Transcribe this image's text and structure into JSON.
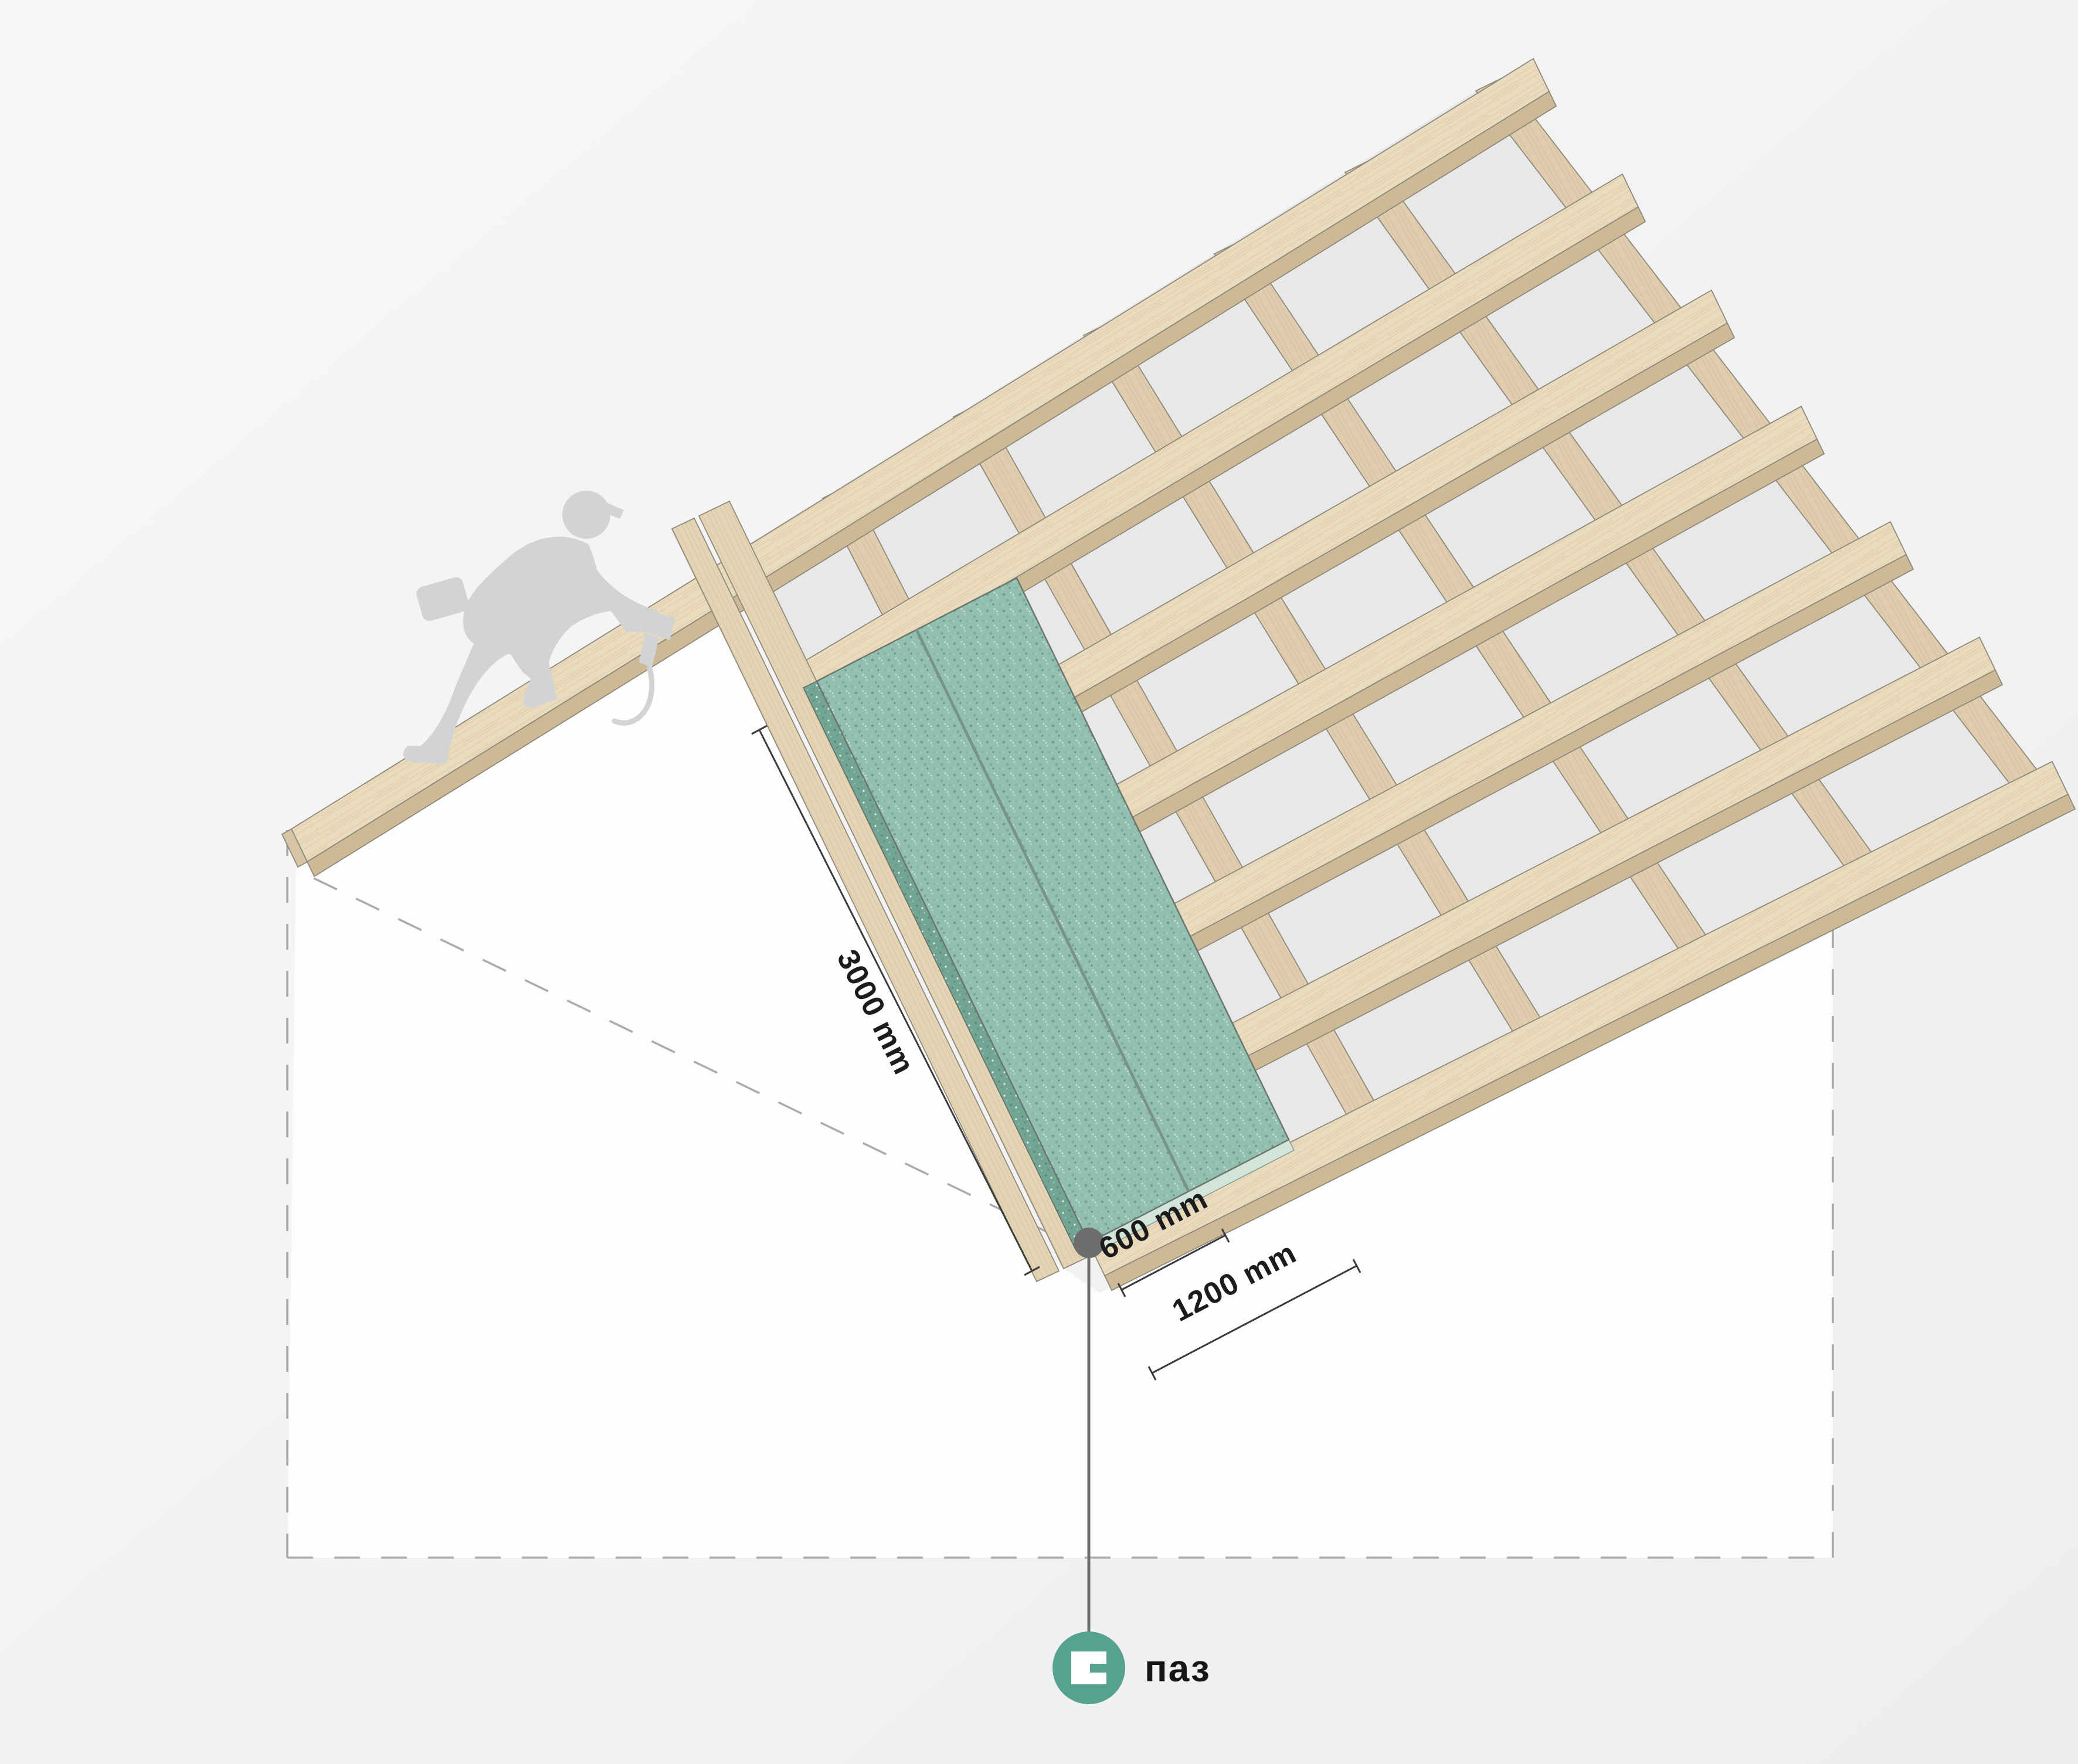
{
  "diagram": {
    "kind": "roof-sheathing-panel-installation-isometric",
    "dimensions": {
      "panel_length": "3000 mm",
      "panel_width": "600 mm",
      "coverage_width": "1200 mm"
    },
    "legend": {
      "icon": "groove-icon",
      "label": "паз"
    },
    "colors": {
      "background": "#f3f3f4",
      "wall": "#fdfdfe",
      "membrane": "#e8e8e9",
      "wood_face": "#e9dbbd",
      "wood_bevel": "#cdb995",
      "rafter_face": "#dcc9a9",
      "panel_green": "#92bfae",
      "panel_edge_dark": "#74a493",
      "panel_edge_light": "#d3e4db",
      "leader_gray": "#6e6e6e",
      "legend_teal": "#56a28e",
      "dimension_line": "#3c3c3c",
      "text": "#1c1c1c",
      "dashed_outline": "#ababab",
      "worker_silhouette": "#d2d3d5"
    }
  }
}
